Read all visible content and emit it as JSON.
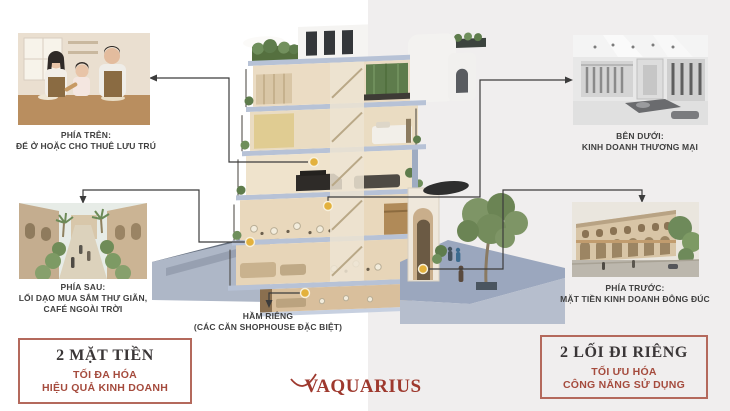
{
  "callouts": {
    "top_left": {
      "title": "PHÍA TRÊN:",
      "line1": "ĐỂ Ở HOẶC CHO THUÊ LƯU TRÚ"
    },
    "back": {
      "title": "PHÍA SAU:",
      "line1": "LỐI DẠO MUA SẮM THƯ GIÃN,",
      "line2": "CAFÉ NGOÀI TRỜI"
    },
    "below": {
      "title": "BÊN DƯỚI:",
      "line1": "KINH DOANH THƯƠNG MẠI"
    },
    "front": {
      "title": "PHÍA TRƯỚC:",
      "line1": "MẶT TIỀN KINH DOANH ĐÔNG ĐÚC"
    },
    "basement": {
      "title": "HẦM RIÊNG",
      "line1": "(CÁC CĂN SHOPHOUSE ĐẶC BIỆT)"
    }
  },
  "highlight_boxes": {
    "left": {
      "heading": "2 MẶT TIỀN",
      "line1": "TỐI ĐA HÓA",
      "line2": "HIỆU QUẢ KINH DOANH"
    },
    "right": {
      "heading": "2 LỐI ĐI RIÊNG",
      "line1": "TỐI ƯU HÓA",
      "line2": "CÔNG NĂNG SỬ DỤNG"
    }
  },
  "logo": {
    "text": "VAQUARIUS"
  },
  "photos": {
    "top_left": {
      "subject": "family-baking-in-kitchen"
    },
    "back": {
      "subject": "landscaped-walking-street"
    },
    "below": {
      "subject": "retail-store-interior"
    },
    "front": {
      "subject": "shophouse-street-front"
    }
  },
  "colors": {
    "accent_text": "#A54B3D",
    "box_border": "#B4695C",
    "heading": "#3A3637",
    "label_text": "#3F3F3F",
    "logo": "#9E392E",
    "marker_dot": "#E3B13C",
    "connector_line": "#3C3C3C",
    "bg_right": "#F0EEEE"
  }
}
